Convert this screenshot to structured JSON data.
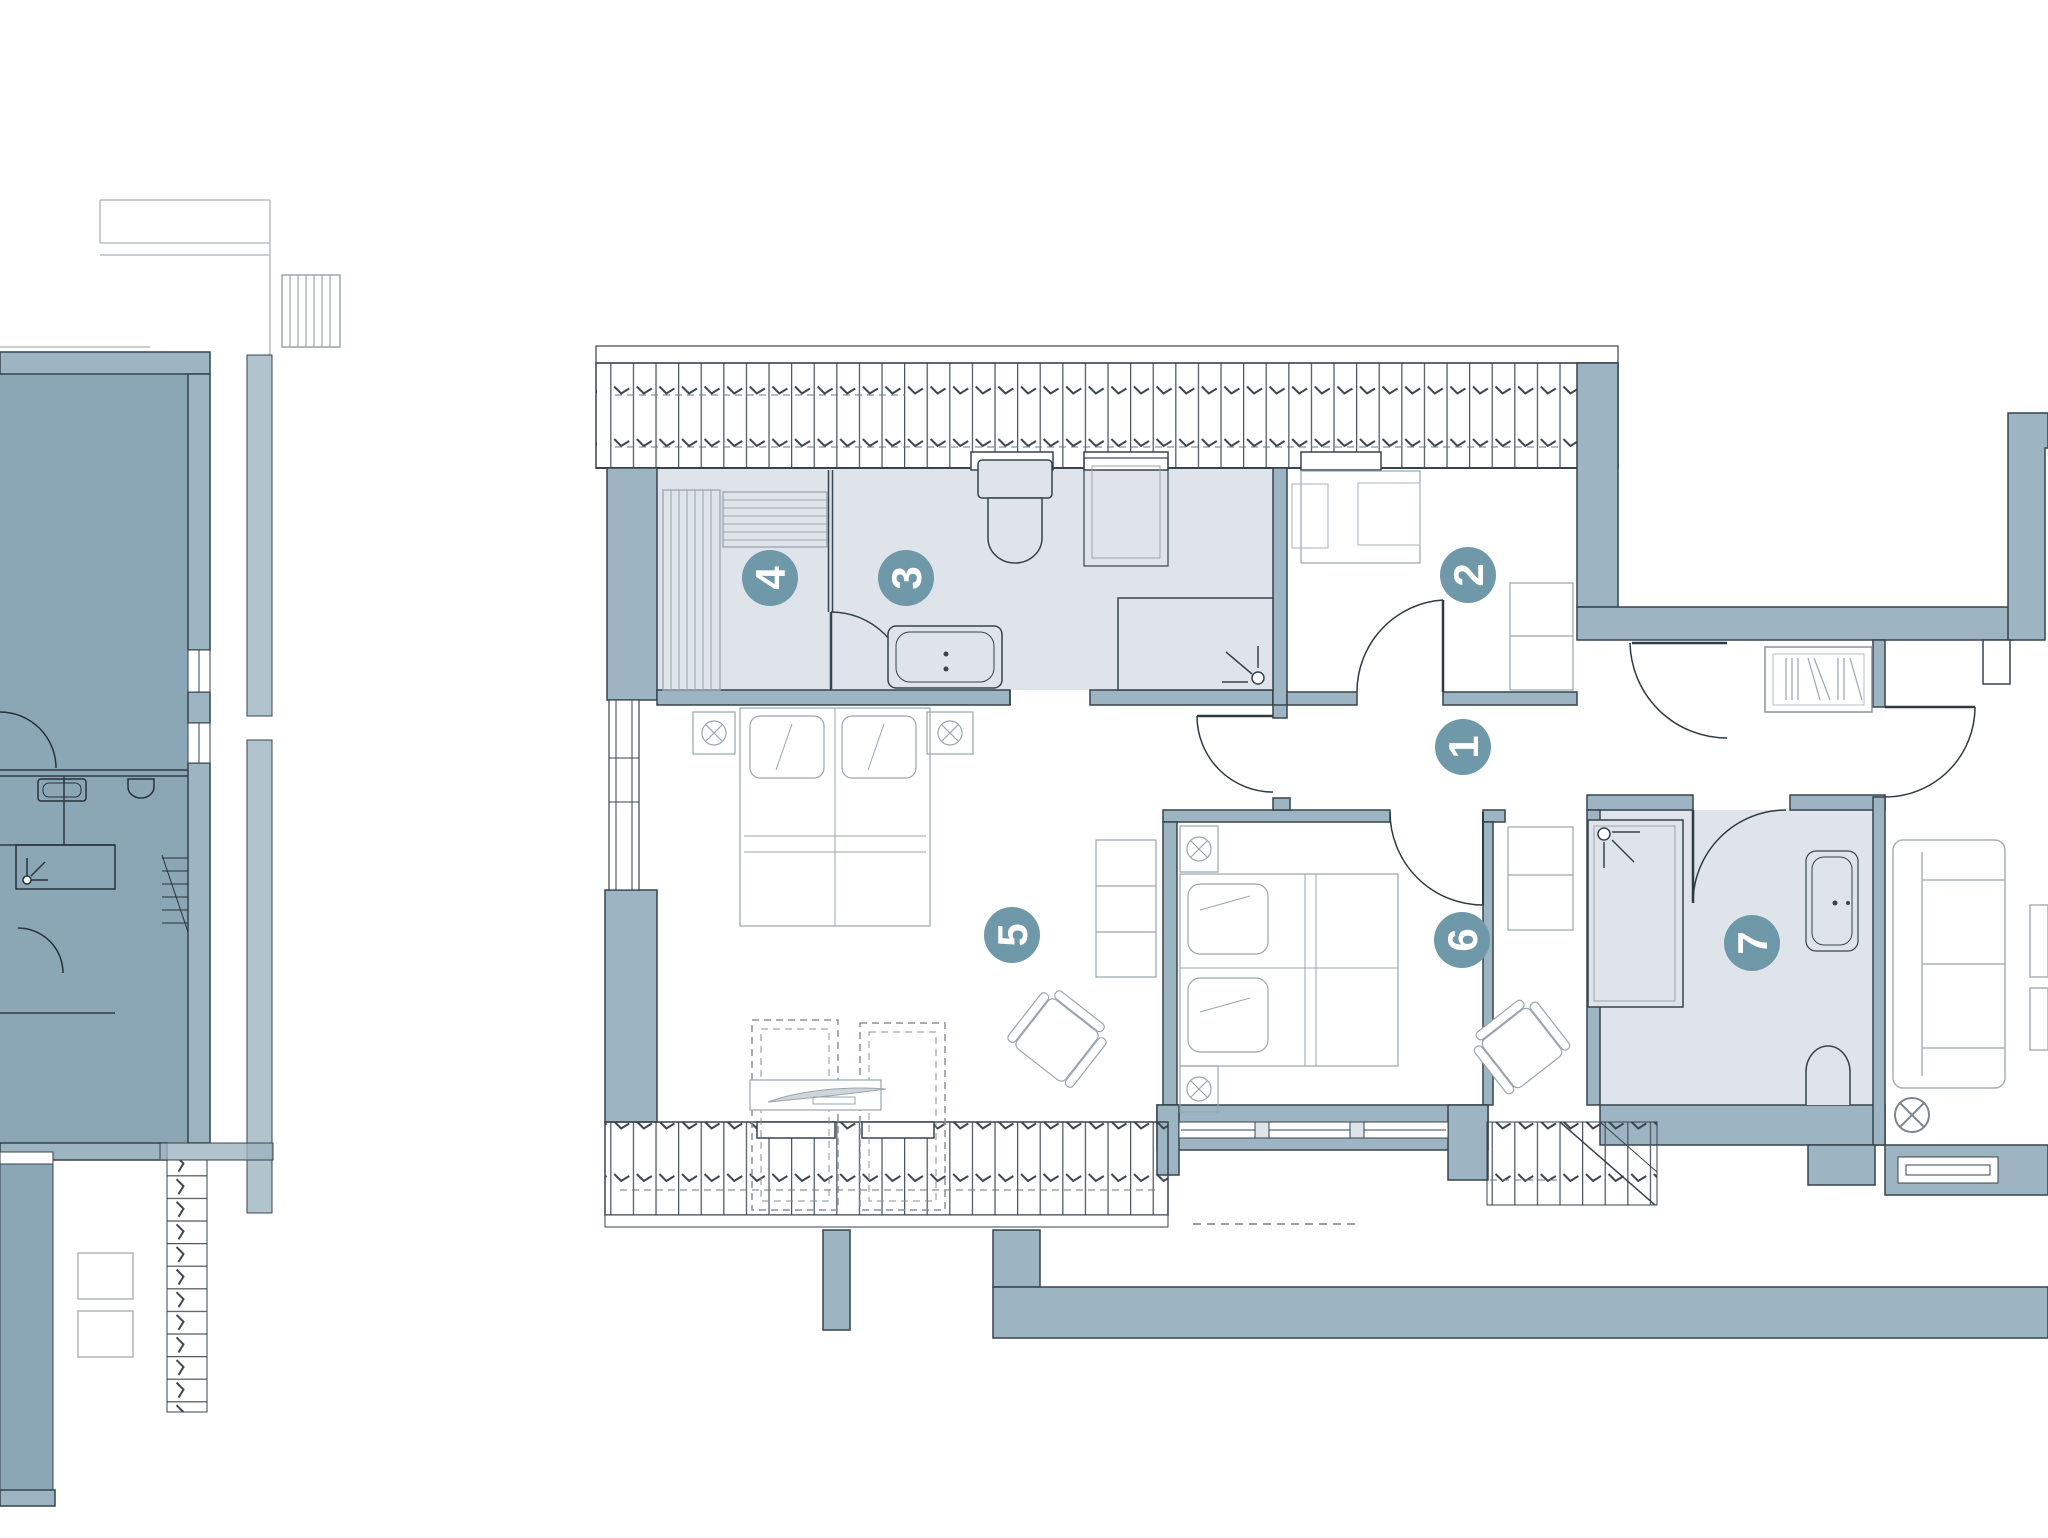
{
  "document": {
    "type": "architectural-floor-plan",
    "description": "Attic apartment floor plan with numbered rooms, adjacent shaded unit on left, partial neighbouring unit on right"
  },
  "markers": [
    {
      "number": "1",
      "role": "hallway"
    },
    {
      "number": "2",
      "role": "bedroom-small"
    },
    {
      "number": "3",
      "role": "bathroom"
    },
    {
      "number": "4",
      "role": "dressing-room"
    },
    {
      "number": "5",
      "role": "bedroom-large"
    },
    {
      "number": "6",
      "role": "bedroom"
    },
    {
      "number": "7",
      "role": "bathroom-2"
    }
  ],
  "palette": {
    "wall_fill": "#9db5c2",
    "wall_outline": "#36444d",
    "room_light_fill": "#dfe4eb",
    "adjacent_unit_fill": "#8ba6b5",
    "marker_circle": "#6f99a9",
    "marker_digit": "#ffffff",
    "furniture_stroke": "#9aa5ad",
    "hatch_stroke": "#4c565e",
    "background": "#ffffff"
  }
}
